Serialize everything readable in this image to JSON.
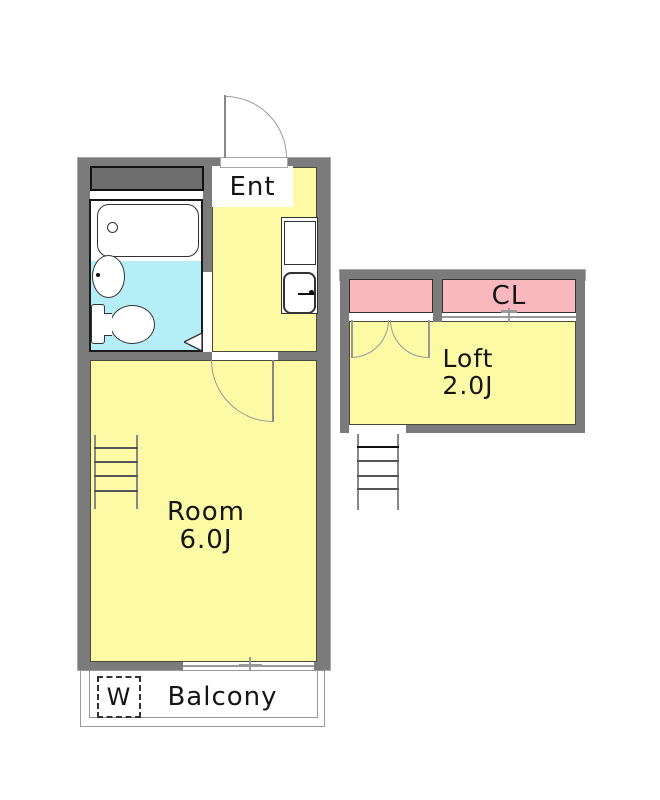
{
  "plan": {
    "type": "apartment-floor-plan",
    "rooms": {
      "entrance": {
        "label": "Ent"
      },
      "main_room": {
        "label": "Room",
        "size": "6.0J"
      },
      "loft": {
        "label": "Loft",
        "size": "2.0J"
      },
      "closet": {
        "label": "CL"
      },
      "balcony": {
        "label": "Balcony"
      },
      "washing_machine": {
        "label": "W"
      }
    },
    "fixtures": [
      "bathtub-icon",
      "bathroom-sink-icon",
      "toilet-icon",
      "kitchen-sink-icon",
      "entrance-door-swing-icon",
      "room-door-swing-icon",
      "loft-double-door-icon",
      "room-ladder-icon",
      "loft-ladder-icon",
      "window-icon",
      "sliding-door-icon",
      "washer-space-icon",
      "storage-block"
    ],
    "colors": {
      "wall_gray": "#7b7b7b",
      "storage_gray": "#6e6e6e",
      "floor_yellow": "#fcfaa5",
      "bath_cyan": "#b5eef6",
      "closet_pink": "#f8b8bd",
      "line_dark": "#1a1a1a"
    }
  }
}
